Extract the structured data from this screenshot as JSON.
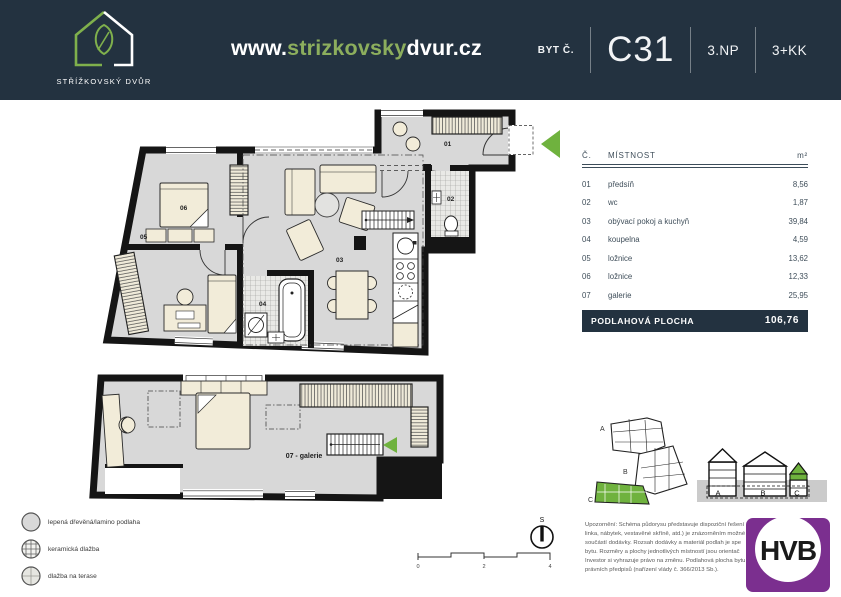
{
  "colors": {
    "navy": "#233240",
    "green_accent": "#6fb23e",
    "green_soft": "#8cae5d",
    "purple": "#7b2f8f",
    "floor_gray": "#d8d8d8",
    "furniture_cream": "#f2ecd9"
  },
  "header": {
    "logo_title": "STŘÍŽKOVSKÝ DVŮR",
    "website": {
      "prefix": "www.",
      "highlight": "strizkovsky",
      "suffix": "dvur.cz"
    },
    "unit": {
      "label": "BYT Č.",
      "number": "C31",
      "floor": "3.NP",
      "layout": "3+KK"
    }
  },
  "room_table": {
    "columns": {
      "number": "Č.",
      "name": "MÍSTNOST",
      "area": "m²"
    },
    "rows": [
      {
        "number": "01",
        "name": "předsíň",
        "area": "8,56"
      },
      {
        "number": "02",
        "name": "wc",
        "area": "1,87"
      },
      {
        "number": "03",
        "name": "obývací pokoj a kuchyň",
        "area": "39,84"
      },
      {
        "number": "04",
        "name": "koupelna",
        "area": "4,59"
      },
      {
        "number": "05",
        "name": "ložnice",
        "area": "13,62"
      },
      {
        "number": "06",
        "name": "ložnice",
        "area": "12,33"
      },
      {
        "number": "07",
        "name": "galerie",
        "area": "25,95"
      }
    ],
    "total": {
      "label": "PODLAHOVÁ PLOCHA",
      "value": "106,76"
    }
  },
  "floor_plan": {
    "labels": {
      "r01": "01",
      "r02": "02",
      "r03": "03",
      "r04": "04",
      "r05": "05",
      "r06": "06",
      "gallery": "07 - galerie"
    }
  },
  "legend": {
    "items": [
      {
        "label": "lepená dřevěná/lamino podlaha",
        "swatch": "plain"
      },
      {
        "label": "keramická dlažba",
        "swatch": "grid"
      },
      {
        "label": "dlažba na terase",
        "swatch": "terrace"
      }
    ]
  },
  "compass": {
    "label": "S"
  },
  "scale_bar": {
    "ticks": [
      "0",
      "2",
      "4"
    ]
  },
  "disclaimer": {
    "lines": [
      "Upozornění: Schéma půdorysu představuje dispoziční řešení",
      "linka, nábytek, vestavěné skříně, atd.) je znázorněním možné",
      "součástí dodávky. Rozsah dodávky a materiál podlah je spe",
      "bytu. Rozměry a plochy jednotlivých místností jsou orientač",
      "Investor si vyhrazuje právo na změnu. Podlahová plocha bytu",
      "právních předpisů (nařízení vlády č. 366/2013 Sb.)."
    ]
  },
  "site_plan": {
    "sections": [
      "A",
      "B",
      "C"
    ],
    "elevation_labels": [
      "A",
      "B",
      "C"
    ]
  },
  "partner_logo": {
    "text": "HVB"
  }
}
